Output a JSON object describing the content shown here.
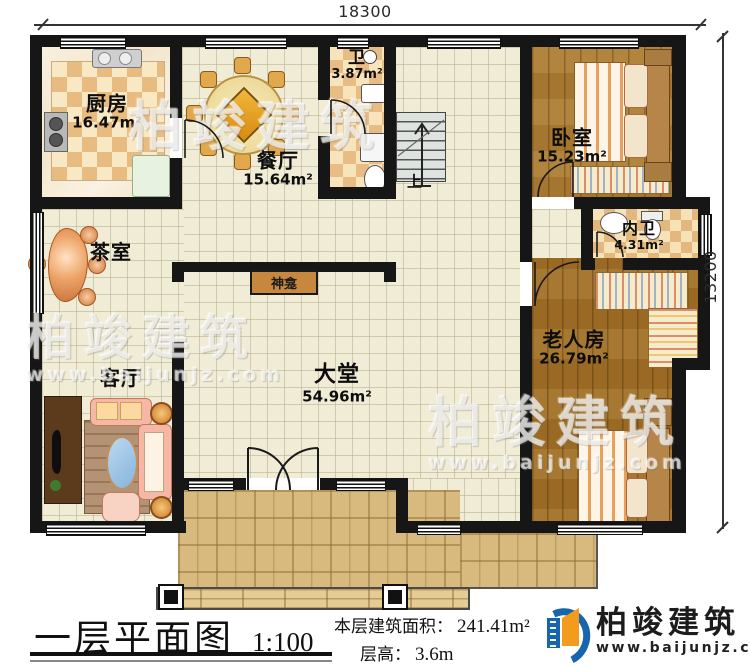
{
  "dimensions": {
    "top": "18300",
    "right": "13200"
  },
  "rooms": {
    "kitchen": {
      "name": "厨房",
      "area": "16.47m²"
    },
    "dining": {
      "name": "餐厅",
      "area": "15.64m²"
    },
    "bath": {
      "name": "卫",
      "area": "3.87m²"
    },
    "bedroom": {
      "name": "卧室",
      "area": "15.23m²"
    },
    "ensuite": {
      "name": "内卫",
      "area": "4.31m²"
    },
    "tea_room": {
      "name": "茶室"
    },
    "living": {
      "name": "客厅"
    },
    "hall": {
      "name": "大堂",
      "area": "54.96m²"
    },
    "elder": {
      "name": "老人房",
      "area": "26.79m²"
    },
    "shrine": {
      "name": "神龛"
    },
    "stairs": {
      "label": "上"
    }
  },
  "titleblock": {
    "plan_title": "一层平面图",
    "scale": "1:100",
    "floor_area_label": "本层建筑面积：",
    "floor_area_value": "241.41m²",
    "floor_height_label": "层高：",
    "floor_height_value": "3.6m"
  },
  "branding": {
    "company": "柏竣建筑",
    "website": "www.baijunjz.com"
  },
  "colors": {
    "wall": "#161616",
    "floor_tile": "#f0ecd6",
    "wood_floor": "#a5762f",
    "checker_tan": "#e7bd85",
    "porch_tile": "#d9ba7e",
    "shrine_box": "#c8873f",
    "logo_blue": "#1766ad",
    "logo_orange": "#f39b1d"
  }
}
